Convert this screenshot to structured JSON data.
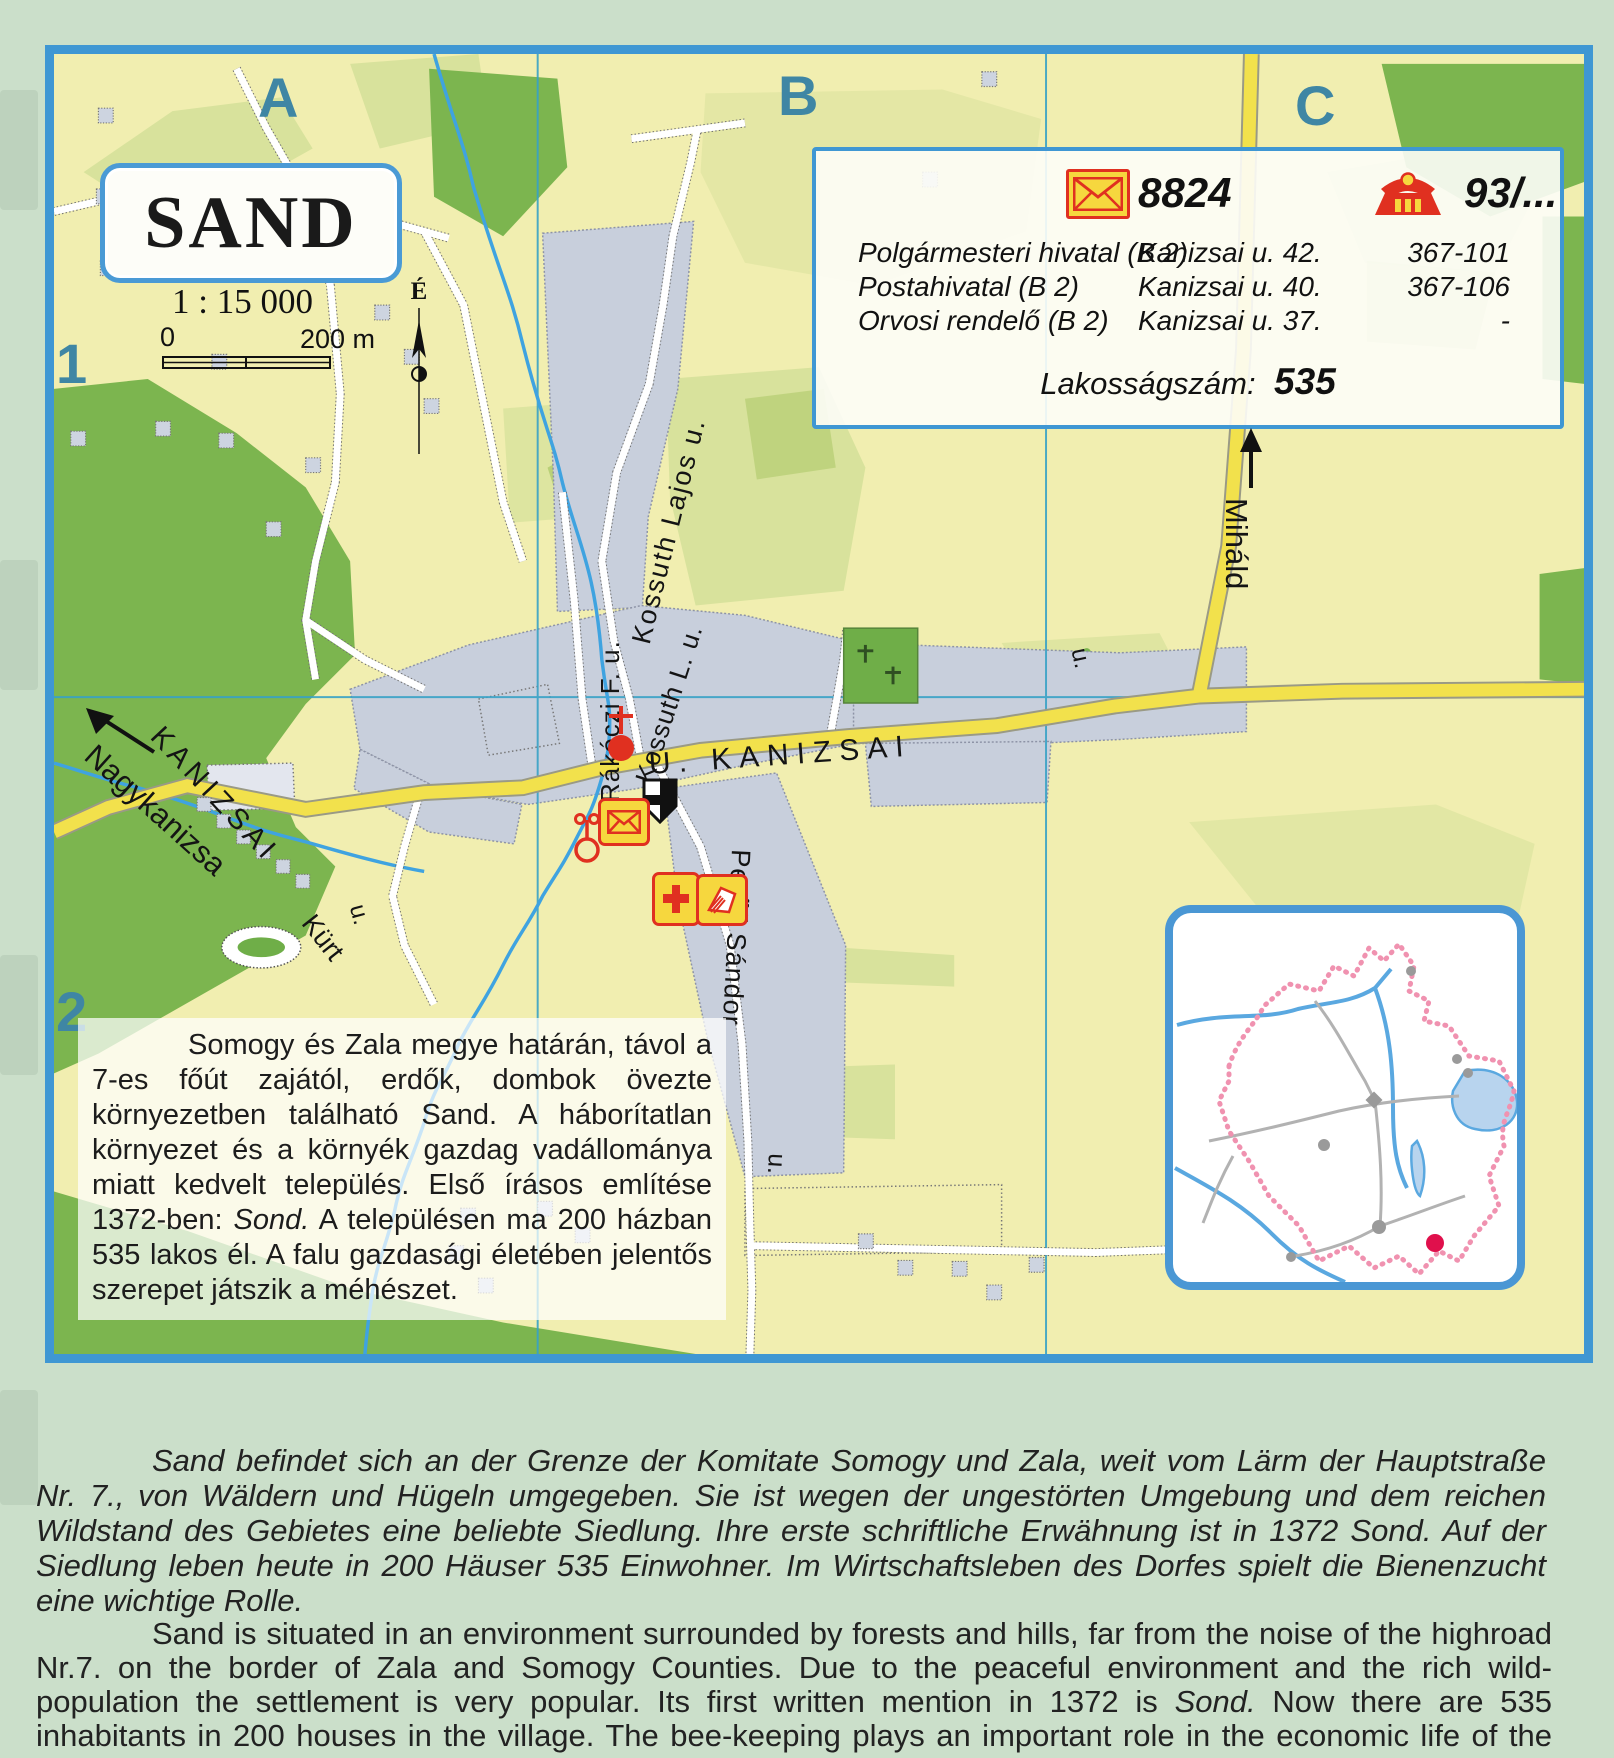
{
  "colors": {
    "frame_blue": "#3f97d3",
    "map_yellow": "#f1eeb0",
    "light_green": "#d8e29c",
    "dark_green": "#7cb54f",
    "builtup_gray": "#c8cfdc",
    "road_yellow": "#f2e14c",
    "water_blue": "#3fa3e0",
    "grid_teal": "#3f86a4",
    "poi_red": "#e03020",
    "poi_yellow": "#f6d73e",
    "page_bg": "#cbdfca"
  },
  "icons": {
    "postal": "envelope-icon",
    "phone": "phone-icon",
    "church": "church-dot-cross-icon",
    "monument": "shield-icon",
    "post_office": "envelope-icon",
    "doctor": "red-cross-icon",
    "library": "book-icon",
    "well": "well-icon",
    "compass": "compass-north-icon",
    "direction_arrow": "arrow-icon"
  },
  "grid": {
    "cols": [
      "A",
      "B",
      "C"
    ],
    "rows": [
      "1",
      "2"
    ]
  },
  "title_box": {
    "title": "SAND",
    "scale": "1 : 15 000",
    "scale_start": "0",
    "scale_end": "200 m",
    "north": "É"
  },
  "info_box": {
    "postal_code": "8824",
    "phone_code": "93/...",
    "rows": [
      {
        "name": "Polgármesteri hivatal (B 2)",
        "address": "Kanizsai u. 42.",
        "phone": "367-101"
      },
      {
        "name": "Postahivatal (B 2)",
        "address": "Kanizsai u. 40.",
        "phone": "367-106"
      },
      {
        "name": "Orvosi rendelő (B 2)",
        "address": "Kanizsai u. 37.",
        "phone": "-"
      }
    ],
    "population_label": "Lakosságszám:",
    "population_value": "535"
  },
  "labels": {
    "kossuth_lajos": "Kossuth Lajos  u.",
    "kossuth_l": "Kossuth L.  u.",
    "rakoczi": "Rákóczi F.  u.",
    "kanizsai_main": "U.  KANIZSAI",
    "kanizsai_west": "KANIZSAI",
    "nagykanizsa": "Nagykanizsa",
    "kurt": "Kürt",
    "kurt_u": "u.",
    "petofi": "Petőfi Sándor",
    "petofi_u": "u.",
    "mihald": "Miháld",
    "junction_u": "u."
  },
  "hu_text": {
    "part1": "Somogy és Zala megye határán, távol a 7-es főút zajától, erdők, dombok övezte környezetben található Sand. A háborítatlan környezet és a környék gazdag vadállománya miatt kedvelt település. Első írásos említése 1372-ben: ",
    "italic": "Sond.",
    "part2": " A településen ma 200 házban 535 lakos él. A falu gazdasági életében jelentős szerepet játszik a méhészet."
  },
  "de_text": {
    "text": "Sand befindet sich an der Grenze der Komitate Somogy und Zala, weit vom Lärm der Hauptstraße Nr. 7., von Wäldern und Hügeln umgegeben. Sie ist wegen der ungestörten Umgebung und dem reichen Wildstand des Gebietes eine beliebte Siedlung. Ihre erste schriftliche Erwähnung ist in 1372 Sond. Auf der Siedlung leben heute in 200 Häuser 535 Einwohner. Im Wirtschaftsleben des Dorfes spielt die Bienenzucht eine wichtige Rolle."
  },
  "en_text": {
    "part1": "Sand is situated in an environment surrounded by forests and hills, far from the noise of the highroad Nr.7. on the border of Zala and Somogy Counties. Due to the peaceful environment and the rich wild-population the settlement is very popular. Its first written mention in 1372 is ",
    "italic": "Sond.",
    "part2": " Now there are 535 inhabitants in 200 houses in the village. The bee-keeping plays an important role in the economic life of the villagers."
  }
}
